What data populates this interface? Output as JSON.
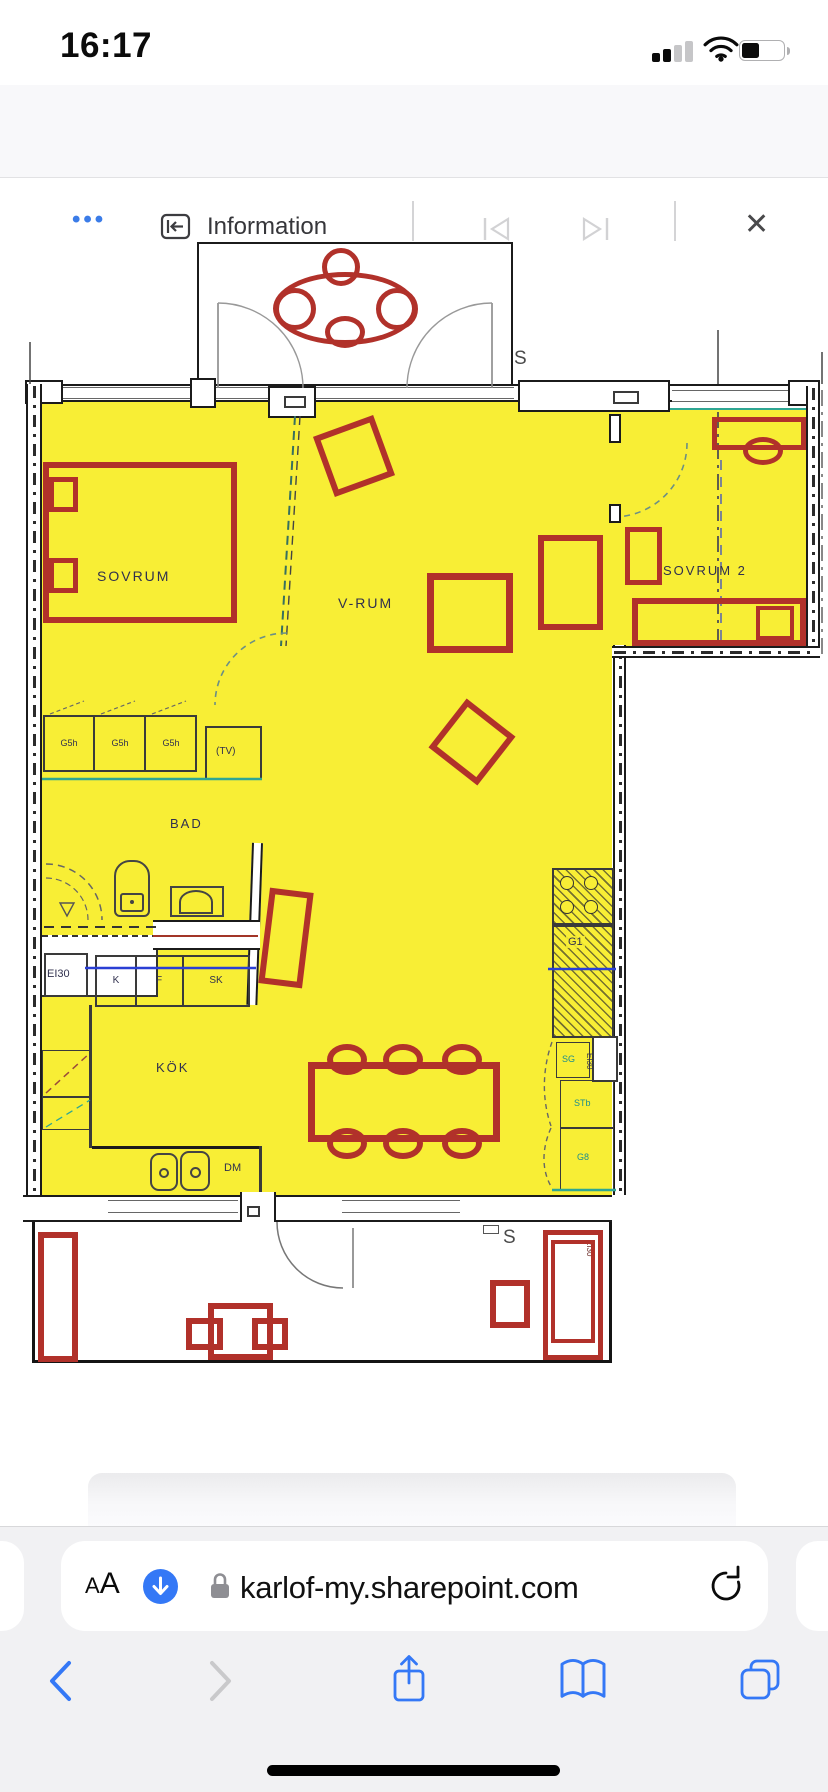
{
  "status_bar": {
    "time": "16:17"
  },
  "viewer_toolbar": {
    "more_label": "•••",
    "title": "Information",
    "close_label": "✕"
  },
  "plan": {
    "rooms": {
      "sovrum": "SOVRUM",
      "vrum": "V-RUM",
      "sovrum2": "SOVRUM 2",
      "bad": "BAD",
      "kok": "KÖK"
    },
    "labels": {
      "s_balcony": "S",
      "s_terrace": "S",
      "tv": "(TV)",
      "dm": "DM",
      "ei30_entry": "EI30",
      "ei30_kitchen": "EI30",
      "ei30_terrace": "EI30",
      "counter": "G1",
      "closets": [
        "G5h",
        "G5h",
        "G5h"
      ],
      "appliances": [
        "K",
        "F",
        "SK"
      ],
      "cabinets": [
        "SG",
        "STb",
        "G8"
      ]
    },
    "colors": {
      "highlight_yellow": "#f8ee35",
      "furniture_red": "#b1312a",
      "wall_black": "#1b1b1b",
      "teal_accent": "#2fa693",
      "blue_accent": "#2a3fd4",
      "label_navy": "#30304e"
    }
  },
  "browser": {
    "reader_small": "A",
    "reader_large": "A",
    "url": "karlof-my.sharepoint.com"
  }
}
